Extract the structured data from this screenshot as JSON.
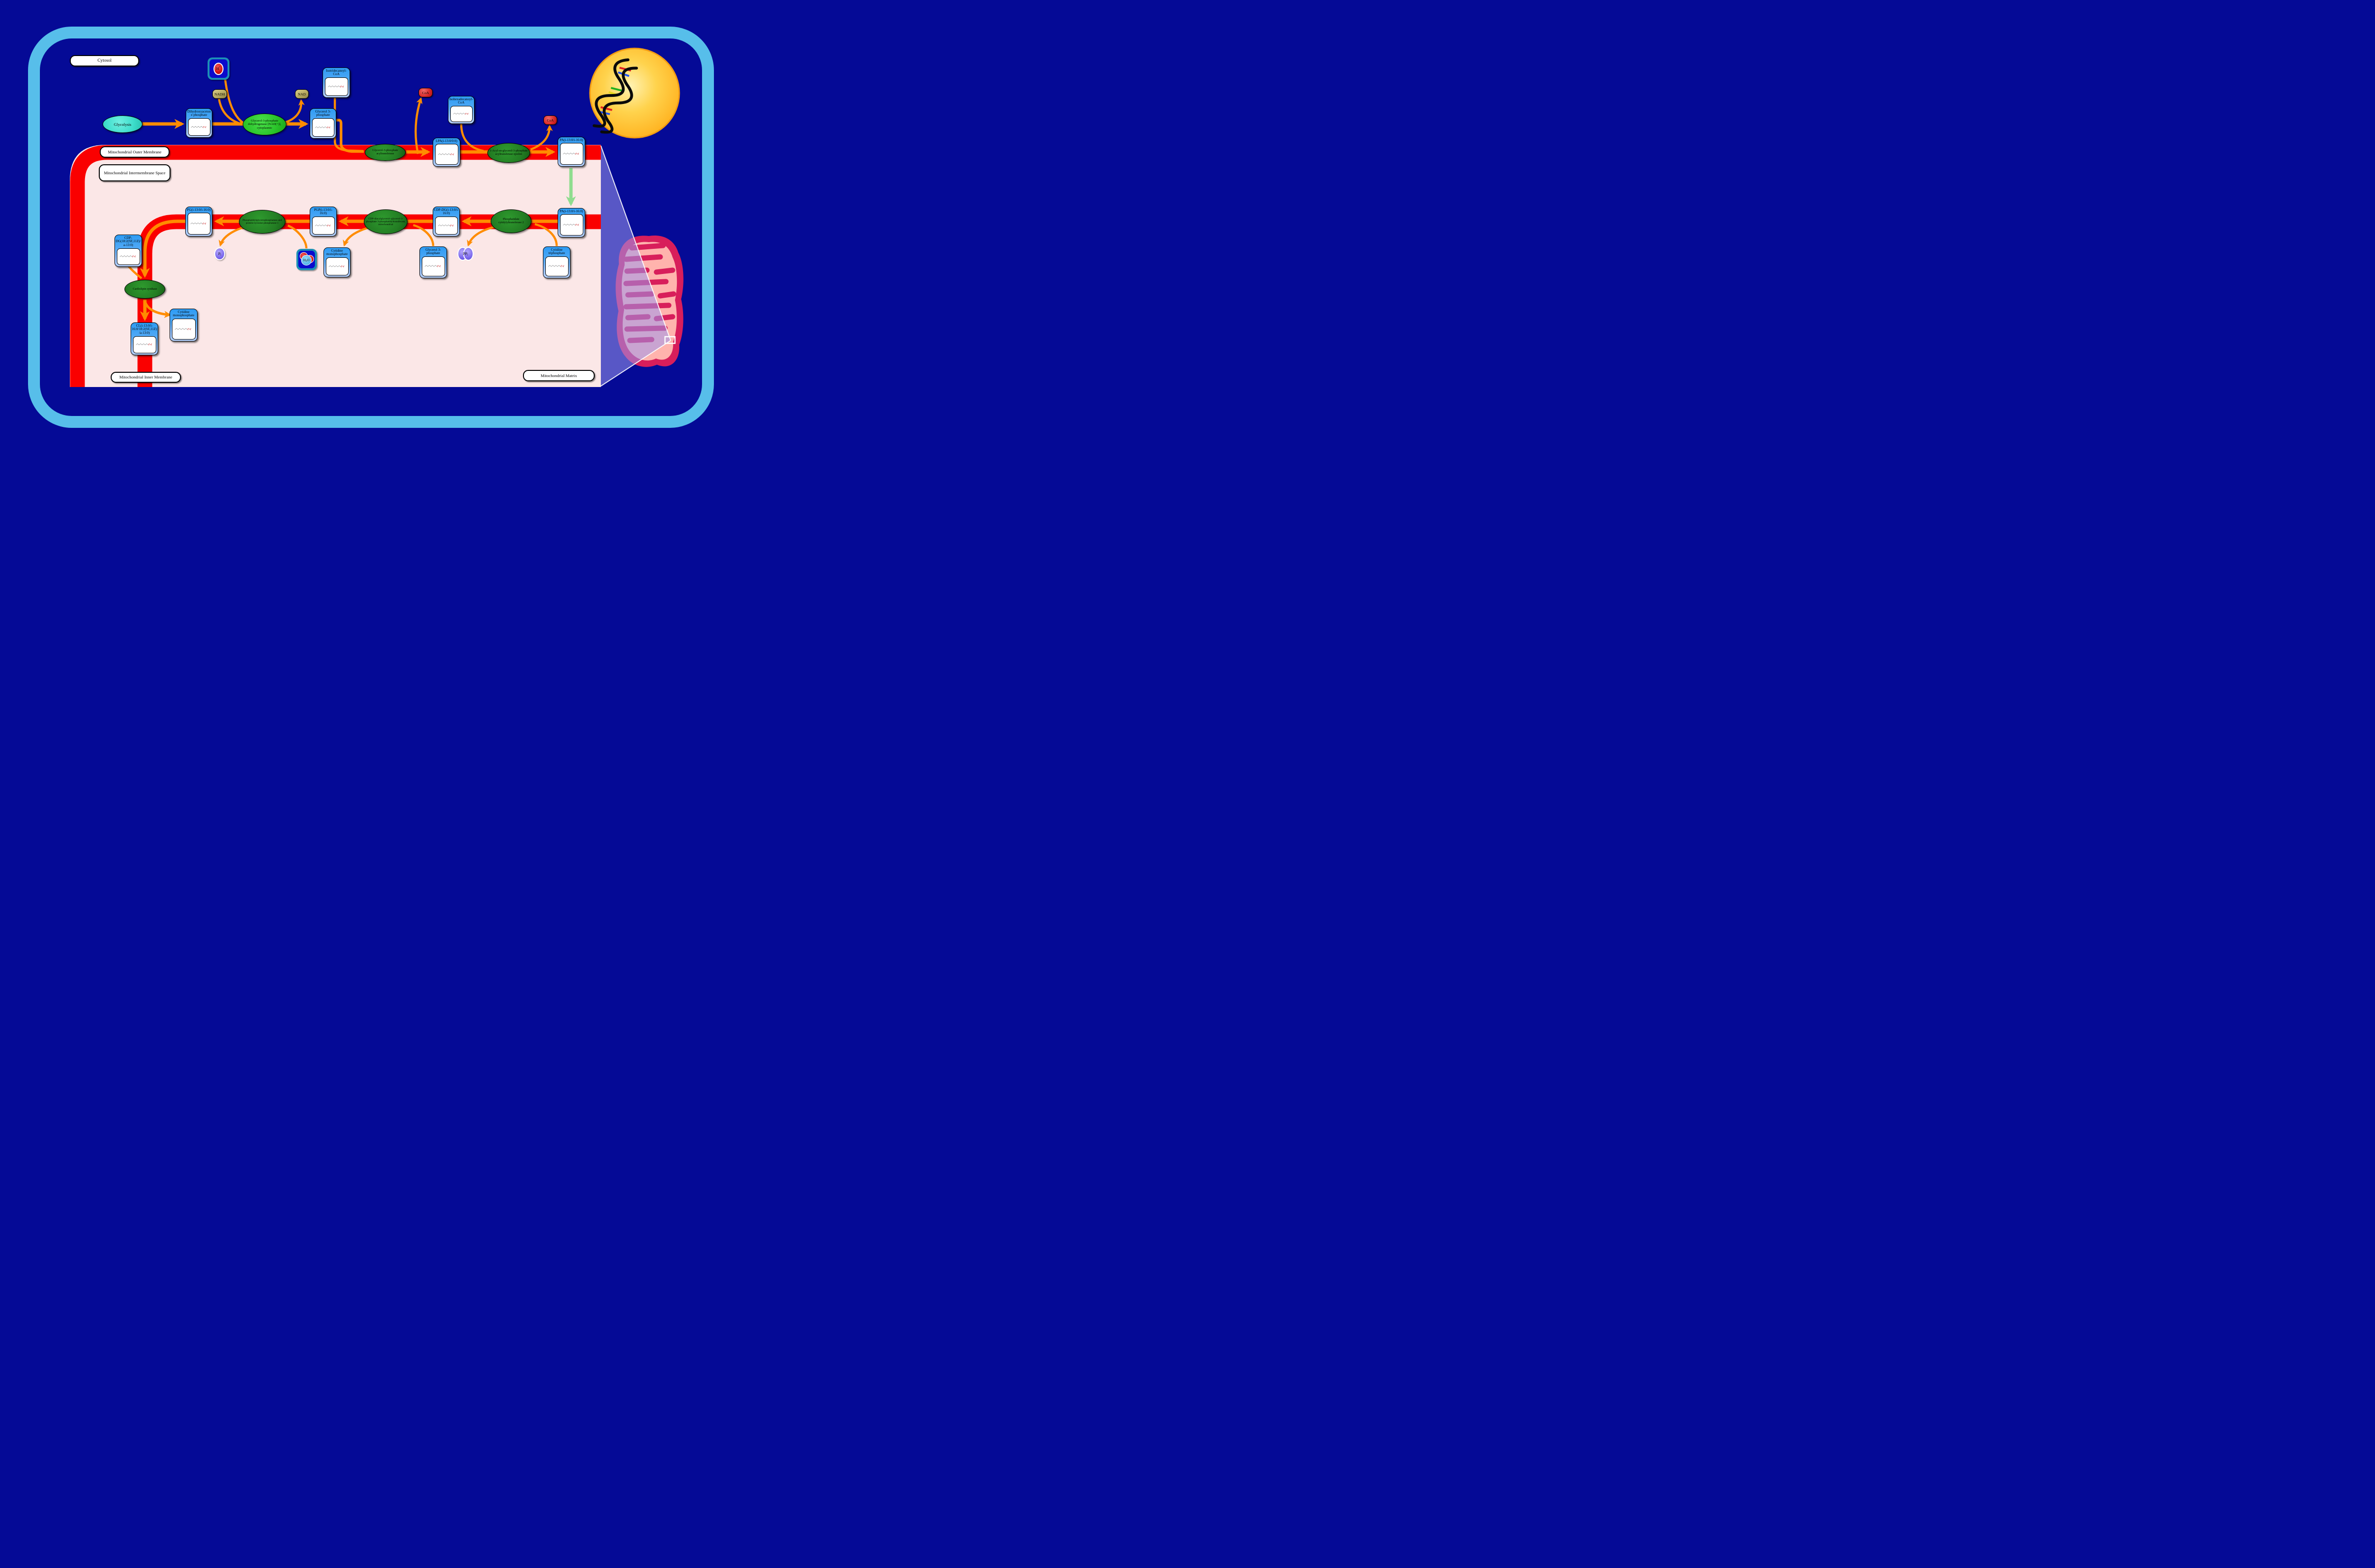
{
  "regions": {
    "cytosol": "Cytosol",
    "outer_membrane": "Mitochondrial Outer Membrane",
    "intermembrane_space": "Mitochondrial Intermembrane Space",
    "inner_membrane": "Mitochondrial Inner Membrane",
    "matrix": "Mitochondrial Matrix"
  },
  "process": {
    "glycolysis": "Glycolysis"
  },
  "metabolites": {
    "dhap": "Dihydroxyacetone phosphate",
    "g3p_cytosol": "Glycerol 3-phosphate",
    "isotridecanoyl_coa": "Isotridecanoyl-CoA",
    "isohexadecanoyl_coa": "Isohexadecanoyl-CoA",
    "lpa": "LPA(i-13:0/0:0)",
    "pa_outer": "PA(i-13:0/i-16:0)",
    "pa_inner": "PA(i-13:0/i-16:0)",
    "cdp_dg_inner": "CDP-DG(i-13:0/i-16:0)",
    "pgp": "PGP(i-13:0/i-16:0)",
    "pg": "PG(i-13:0/i-16:0)",
    "cdp_dg_left": "CDP-DG(18:2(9Z,11Z)/a-13:0)",
    "cl": "CL(i-13:0/i-16:0/18:2(9Z,11Z)/a-13:0)",
    "cmp_upper": "Cytidine monophosphate",
    "cmp_lower": "Cytidine monophosphate",
    "ctp": "Cytidine triphosphate",
    "g3p_matrix": "Glycerol 3-phosphate"
  },
  "cofactors": {
    "nadh": "NADH",
    "nad": "NAD",
    "coa_1": "CoA",
    "coa_2": "CoA",
    "proton": {
      "base": "H",
      "sup": "+"
    },
    "pi": {
      "base": "P",
      "sub": "i"
    },
    "ppi": {
      "base": "PP",
      "sub": "i"
    },
    "water": {
      "h": "H",
      "sub": "2",
      "o": "O"
    }
  },
  "enzymes": {
    "gpd": "Glycerol-3-phosphate dehydrogenase [NAD(+)], cytoplasmic",
    "gpat": "Glycerol-3-phosphate acyltransferase",
    "agpat": "1-Acyl-sn-glycerol-3-phosphate acyltransferase epsilon",
    "cds2": "Phosphatidate cytidylyltransferase 2",
    "pgs1": "CDP-diacylglycerol--glycerol-3-phosphate 3-phosphatidyltransferase, mitochondrial",
    "ptpmt1": "Phosphatidylglycerophosphatase and protein-tyrosine phosphatase 1",
    "cls": "Cardiolipin synthase"
  },
  "colors": {
    "background_navy": "#050A96",
    "frame_blue": "#57BEEA",
    "membrane_red": "#FA0000",
    "matrix_pink": "#FBE7E7",
    "arrow_orange": "#FF8C00",
    "transport_green": "#8FDC8F",
    "enzyme_green_dark": "#237D23",
    "enzyme_green_bright": "#2BC52B",
    "node_blue": "#2D9BF3",
    "nucleus_gold": "#FFC02E",
    "mitochondrion_crimson": "#D81E5B",
    "mitochondrion_pink": "#FFB3AD"
  }
}
